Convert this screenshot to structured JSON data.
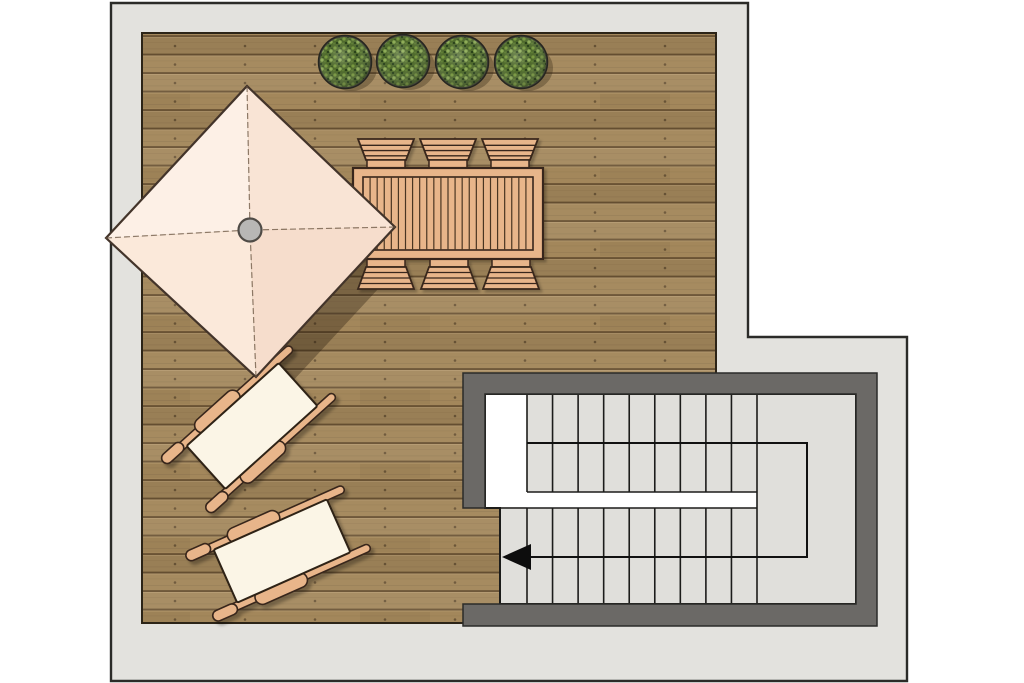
{
  "meta": {
    "title": "Roof terrace floor plan",
    "view": "top-down"
  },
  "colors": {
    "background": "#ffffff",
    "surround": "#e3e2de",
    "outline": "#2b2b28",
    "deck_base": "#a3875b",
    "deck_gap": "#6a5334",
    "deck_outline": "#2c2417",
    "screw": "#463521",
    "wall": "#6b6966",
    "stair_floor": "#e0dfdb",
    "stair_line": "#1c1c1a",
    "white": "#ffffff",
    "furniture_wood": "#e8b58a",
    "furniture_outline": "#38271a",
    "slat_gap": "#4a3420",
    "mattress": "#fbf5e6",
    "mattress_outline": "#2e2214",
    "canopy_panels": [
      "#fdf0e6",
      "#f9e4d5",
      "#f6ddcc",
      "#fbe9da"
    ],
    "canopy_outline": "#43342a",
    "seam": "#6b5642",
    "pole_fill": "#b8b7b5",
    "pole_outline": "#4f4b46",
    "shadow": "rgba(33,20,8,0.33)",
    "soft_shadow": "rgba(35,25,10,0.30)",
    "foliage_base": "#4f6a2c",
    "foliage_light": "#8cab55",
    "foliage_mid": "#77983e",
    "foliage_dark": "#27401a",
    "pot": "#42423a",
    "pot_rim": "#26261f"
  },
  "building": {
    "path": "M111,3 H748 V337 H907 V681 H111 Z"
  },
  "deck": {
    "x": 142,
    "y": 33,
    "w": 574,
    "h": 590,
    "plank_pitch": 18.5,
    "plank_direction": "horizontal"
  },
  "planters": {
    "count": 4,
    "radius": 25,
    "centers": [
      [
        345,
        62
      ],
      [
        403,
        61
      ],
      [
        462,
        62
      ],
      [
        521,
        62
      ]
    ]
  },
  "dining": {
    "table": {
      "x": 353,
      "y": 168,
      "w": 190,
      "h": 91,
      "inner": [
        363,
        177,
        170,
        73
      ],
      "slat_count": 24
    },
    "chairs": {
      "count": 6,
      "top_cx": [
        386,
        448,
        510
      ],
      "bottom_cx": [
        386,
        449,
        511
      ],
      "top": {
        "back_top": 139,
        "back_bottom": 160,
        "seat_bottom": 169,
        "half_top": 28,
        "half_bottom": 20,
        "seat_half": 19
      },
      "bottom": {
        "seat_top": 258,
        "back_top": 267,
        "back_bottom": 289,
        "half_top": 20,
        "half_bottom": 28,
        "seat_half": 19
      }
    }
  },
  "umbrella": {
    "vertices": [
      [
        106,
        238
      ],
      [
        247,
        86
      ],
      [
        395,
        227
      ],
      [
        256,
        377
      ]
    ],
    "center": [
      250,
      230
    ],
    "pole_radius": 11.5,
    "shadow_offset": [
      22,
      20
    ]
  },
  "loungers": {
    "count": 2,
    "placements": [
      {
        "cx": 252,
        "cy": 426,
        "angle": -42
      },
      {
        "cx": 282,
        "cy": 551,
        "angle": -24
      }
    ],
    "shape": {
      "mattress": [
        -62,
        -29,
        124,
        58
      ],
      "rails": [
        [
          -82,
          -36,
          164,
          8
        ],
        [
          -82,
          28,
          164,
          8
        ]
      ],
      "pads": [
        [
          -44,
          -41.5,
          56,
          15
        ],
        [
          -44,
          26.5,
          56,
          15
        ]
      ],
      "caps": [
        [
          -90,
          -38.5,
          26,
          11
        ],
        [
          -90,
          27.5,
          26,
          11
        ]
      ]
    }
  },
  "staircase": {
    "wall_path": "M463,373 H877 V626 H463 V604 H856 V394 H485 V508 H463 Z",
    "floor_path": "M485,394 H856 V604 H500 V508 H485 Z",
    "landing_white": [
      486,
      395,
      41,
      112
    ],
    "gap_white": [
      527,
      492,
      230,
      16
    ],
    "gap_lines": [
      [
        527,
        492,
        757,
        492
      ],
      [
        500,
        508,
        757,
        508
      ]
    ],
    "treads": {
      "x_start": 527,
      "x_end": 757,
      "line_count": 10,
      "upper_y": [
        394,
        492
      ],
      "lower_y": [
        508,
        604
      ],
      "steps_per_flight": 9
    },
    "walk_line": {
      "path": "M527,443 H807 V557 H512",
      "arrow": [
        [
          502,
          557
        ],
        [
          531,
          544
        ],
        [
          531,
          570
        ]
      ],
      "direction": "left"
    }
  }
}
